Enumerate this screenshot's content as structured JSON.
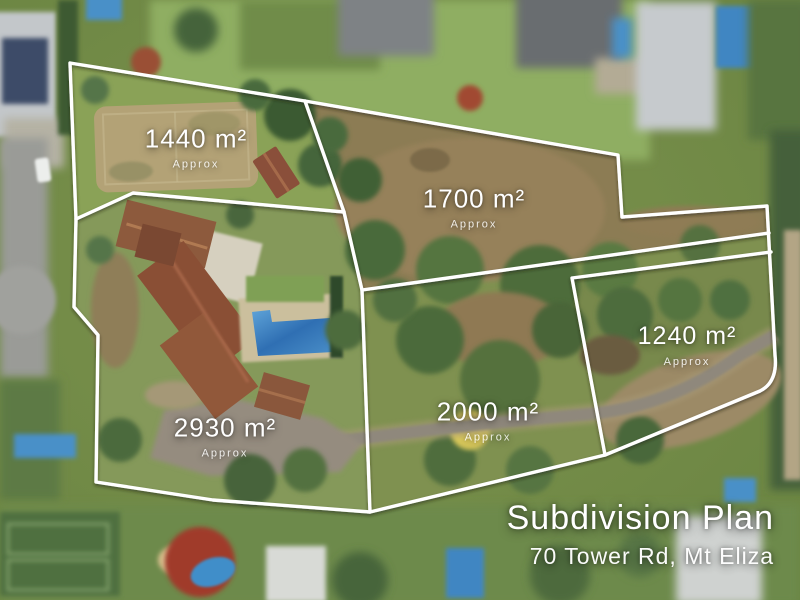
{
  "plan": {
    "title": "Subdivision Plan",
    "address": "70 Tower Rd, Mt Eliza",
    "lots": [
      {
        "name": "lot-1440",
        "area": "1440 m²",
        "approx": "Approx"
      },
      {
        "name": "lot-1700",
        "area": "1700 m²",
        "approx": "Approx"
      },
      {
        "name": "lot-2930",
        "area": "2930 m²",
        "approx": "Approx"
      },
      {
        "name": "lot-2000",
        "area": "2000 m²",
        "approx": "Approx"
      },
      {
        "name": "lot-1240",
        "area": "1240 m²",
        "approx": "Approx"
      }
    ],
    "colors": {
      "boundary_line": "#ffffff",
      "label_text": "#ffffff",
      "lawn_green": "#84995a",
      "dirt_tan": "#96815a",
      "pool_blue": "#3f86c2",
      "roof_terracotta": "#8a5138"
    }
  }
}
